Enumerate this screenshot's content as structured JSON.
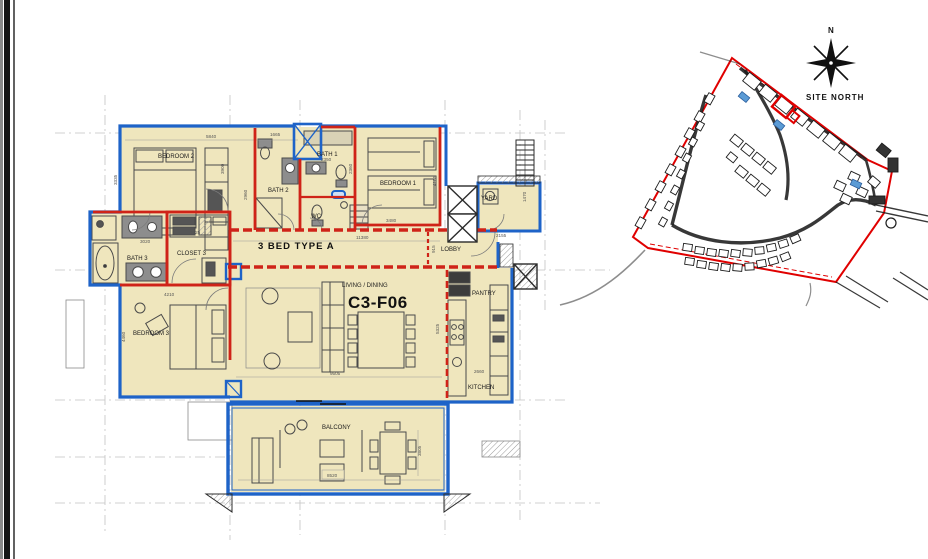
{
  "drawing": {
    "unit_code": "C3-F06",
    "plan_title": "3 BED TYPE A",
    "area_label": "LIVING / DINING",
    "rooms": {
      "bedroom1": "BEDROOM 1",
      "bedroom2": "BEDROOM 2",
      "bedroom3": "BEDROOM 3",
      "bath1": "BATH 1",
      "bath2": "BATH 2",
      "bath3": "BATH 3",
      "wc": "WC",
      "closet3": "CLOSET 3",
      "yard": "YARD",
      "lobby": "LOBBY",
      "pantry": "PANTRY",
      "kitchen": "KITCHEN",
      "balcony": "BALCONY"
    },
    "dimensions": {
      "bedroom2_width": "5840",
      "bedroom2_depth": "3335",
      "wardrobe_wall": "3900",
      "hall_depth": "2960",
      "bath2_width": "1665",
      "bath1_width": "2350",
      "bath1_depth": "2360",
      "bedroom1_width": "3480",
      "bedroom1_depth": "4185",
      "yard_width": "2155",
      "yard_depth": "1470",
      "unit_width": "11380",
      "closet3_width": "2125",
      "bath3_width": "3020",
      "bedroom3_width": "4210",
      "bedroom3_depth": "4460",
      "living_width": "9505",
      "kitchen_depth": "5325",
      "kitchen_width": "2660",
      "balcony_width": "8520",
      "balcony_depth": "3805",
      "lobby_depth": "915"
    },
    "site": {
      "north_letter": "N",
      "north_label": "SITE NORTH"
    },
    "colors": {
      "wall_red": "#cf2318",
      "wall_blue": "#1e63c8",
      "room_fill": "#efe6bd",
      "boundary_red": "#e00000",
      "pool_blue": "#5b9bd5"
    }
  }
}
